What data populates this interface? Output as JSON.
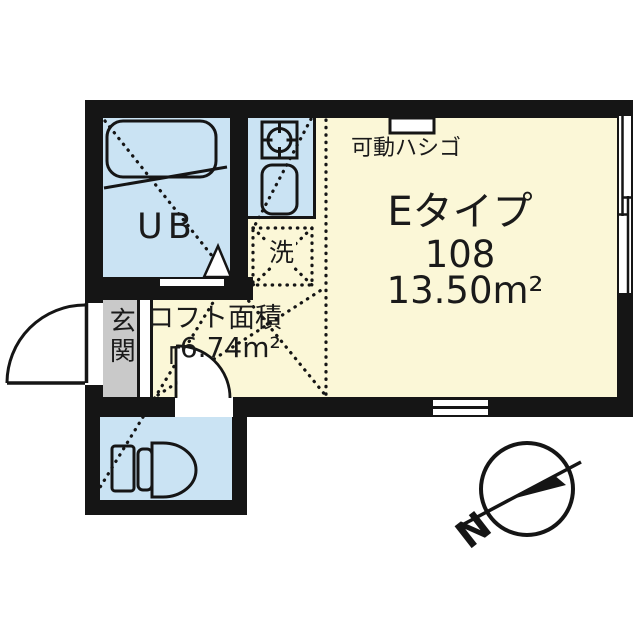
{
  "floorplan": {
    "main_room": {
      "type_label": "Eタイプ",
      "unit_number": "108",
      "area_label": "13.50m²"
    },
    "loft": {
      "label": "ロフト面積",
      "area_label": "┌6.74m²"
    },
    "unit_bath": {
      "label": "UB"
    },
    "entrance": {
      "label": "玄関"
    },
    "laundry": {
      "label": "洗"
    },
    "movable_ladder": {
      "label": "可動ハシゴ"
    },
    "compass": {
      "north_label": "N"
    },
    "colors": {
      "wall": "#151515",
      "room_yellow": "#FBF7D7",
      "wet_area_blue": "#CAE3F3",
      "entrance_gray": "#C9C9C9"
    }
  }
}
